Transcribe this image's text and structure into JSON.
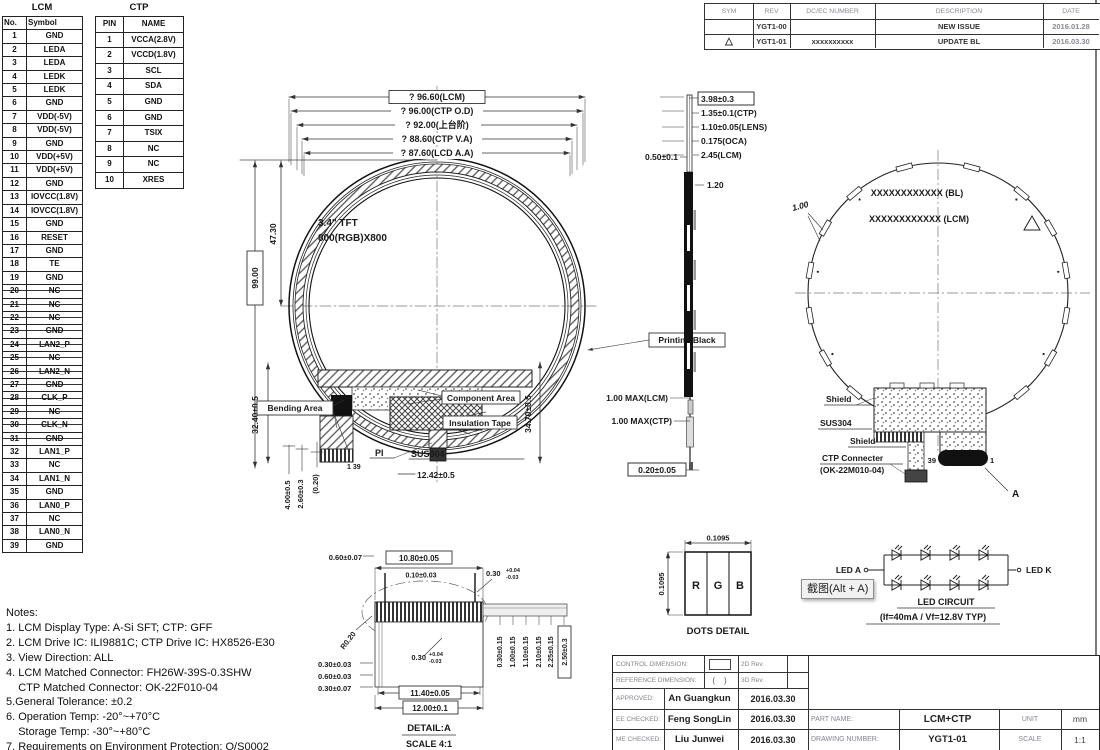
{
  "lcm_table": {
    "title": "LCM",
    "headers": [
      "No.",
      "Symbol"
    ],
    "struck_rows": [
      20,
      21,
      22,
      23,
      24,
      25,
      26,
      27,
      28,
      29,
      30,
      31
    ],
    "rows": [
      [
        "1",
        "GND"
      ],
      [
        "2",
        "LEDA"
      ],
      [
        "3",
        "LEDA"
      ],
      [
        "4",
        "LEDK"
      ],
      [
        "5",
        "LEDK"
      ],
      [
        "6",
        "GND"
      ],
      [
        "7",
        "VDD(-5V)"
      ],
      [
        "8",
        "VDD(-5V)"
      ],
      [
        "9",
        "GND"
      ],
      [
        "10",
        "VDD(+5V)"
      ],
      [
        "11",
        "VDD(+5V)"
      ],
      [
        "12",
        "GND"
      ],
      [
        "13",
        "IOVCC(1.8V)"
      ],
      [
        "14",
        "IOVCC(1.8V)"
      ],
      [
        "15",
        "GND"
      ],
      [
        "16",
        "RESET"
      ],
      [
        "17",
        "GND"
      ],
      [
        "18",
        "TE"
      ],
      [
        "19",
        "GND"
      ],
      [
        "20",
        "NC"
      ],
      [
        "21",
        "NC"
      ],
      [
        "22",
        "NC"
      ],
      [
        "23",
        "GND"
      ],
      [
        "24",
        "LAN2_P"
      ],
      [
        "25",
        "NC"
      ],
      [
        "26",
        "LAN2_N"
      ],
      [
        "27",
        "GND"
      ],
      [
        "28",
        "CLK_P"
      ],
      [
        "29",
        "NC"
      ],
      [
        "30",
        "CLK_N"
      ],
      [
        "31",
        "GND"
      ],
      [
        "32",
        "LAN1_P"
      ],
      [
        "33",
        "NC"
      ],
      [
        "34",
        "LAN1_N"
      ],
      [
        "35",
        "GND"
      ],
      [
        "36",
        "LAN0_P"
      ],
      [
        "37",
        "NC"
      ],
      [
        "38",
        "LAN0_N"
      ],
      [
        "39",
        "GND"
      ]
    ]
  },
  "ctp_table": {
    "title": "CTP",
    "headers": [
      "PIN",
      "NAME"
    ],
    "rows": [
      [
        "1",
        "VCCA(2.8V)"
      ],
      [
        "2",
        "VCCD(1.8V)"
      ],
      [
        "3",
        "SCL"
      ],
      [
        "4",
        "SDA"
      ],
      [
        "5",
        "GND"
      ],
      [
        "6",
        "GND"
      ],
      [
        "7",
        "TSIX"
      ],
      [
        "8",
        "NC"
      ],
      [
        "9",
        "NC"
      ],
      [
        "10",
        "XRES"
      ]
    ]
  },
  "revision": {
    "h_sym": "SYM",
    "h_rev": "REV",
    "h_dc": "DC/EC NUMBER",
    "h_desc": "DESCRIPTION",
    "h_date": "DATE",
    "r1_sym": "",
    "r1_rev": "YGT1-00",
    "r1_dc": "",
    "r1_desc": "NEW ISSUE",
    "r1_date": "2016.01.28",
    "r2_sym": "△",
    "r2_rev": "YGT1-01",
    "r2_dc": "xxxxxxxxxx",
    "r2_desc": "UPDATE BL",
    "r2_date": "2016.03.30"
  },
  "front_view": {
    "dia_lcm": "? 96.60(LCM)",
    "dia_ctp_od": "? 96.00(CTP O.D)",
    "dia_step": "? 92.00(上台阶)",
    "dia_ctp_va": "? 88.60(CTP V.A)",
    "dia_lcd_aa": "? 87.60(LCD A.A)",
    "panel_line1": "3.4\" TFT",
    "panel_line2": "800(RGB)X800",
    "dim_47_30": "47.30",
    "dim_99_00": "99.00",
    "dim_32_40": "32.40±0.5",
    "dim_34_70": "34.70±0.5",
    "dim_4_00": "4.00±0.5",
    "dim_2_60": "2.60±0.3",
    "dim_0_20": "(0.20)",
    "dim_12_42": "12.42±0.5",
    "label_printing_black": "Printing Black",
    "label_bending_area": "Bending Area",
    "label_component_area": "Component Area",
    "label_insulation_tape": "Insulation Tape",
    "label_pi": "PI",
    "label_sus304": "SUS304",
    "pin_marks": "1 39"
  },
  "side_view": {
    "dim_total": "3.98±0.3",
    "dim_ctp": "1.35±0.1(CTP)",
    "dim_lens": "1.10±0.05(LENS)",
    "dim_oca": "0.175(OCA)",
    "dim_lcm": "2.45(LCM)",
    "dim_gap": "0.50±0.1",
    "dim_step": "1.20",
    "dim_lcm_max": "1.00 MAX(LCM)",
    "dim_ctp_max": "1.00 MAX(CTP)",
    "dim_tail": "0.20±0.05"
  },
  "back_view": {
    "label_bl": "XXXXXXXXXXXX (BL)",
    "label_lcm": "XXXXXXXXXXXX (LCM)",
    "dim_1_00": "1.00",
    "shield1": "Shield",
    "sus304": "SUS304",
    "shield2": "Shield",
    "conn1": "CTP Connecter",
    "conn2": "(OK-22M010-04)",
    "pin39": "39",
    "pin1": "1",
    "ref_a": "A"
  },
  "detail_a": {
    "top_left": "0.60±0.07",
    "width_top": "10.80±0.05",
    "pin_w": "0.10±0.03",
    "pitch": "0.30",
    "pitch_p": "+0.04",
    "pitch_m": "-0.03",
    "radius": "R0.20",
    "mid": "0.30",
    "mid_p": "+0.04",
    "mid_m": "-0.03",
    "left1": "0.30±0.03",
    "left2": "0.60±0.03",
    "left3": "0.30±0.07",
    "r1": "0.30±0.15",
    "r2": "1.00±0.15",
    "r3": "1.10±0.15",
    "r4": "2.10±0.15",
    "r5": "2.25±0.15",
    "r6": "2.50±0.3",
    "width_mid": "11.40±0.05",
    "width_bot": "12.00±0.1",
    "title": "DETAIL:A",
    "scale": "SCALE 4:1"
  },
  "dots_detail": {
    "dim_w": "0.1095",
    "dim_h": "0.1095",
    "r": "R",
    "g": "G",
    "b": "B",
    "label": "DOTS DETAIL"
  },
  "led_circuit": {
    "anode": "LED A",
    "cathode": "LED K",
    "title": "LED CIRCUIT",
    "spec": "(If=40mA / Vf=12.8V TYP)",
    "tooltip": "截图(Alt + A)"
  },
  "notes": {
    "lines": [
      "Notes:",
      "1. LCM Display Type: A-Si SFT; CTP: GFF",
      "2. LCM Drive IC: ILI9881C; CTP Drive IC: HX8526-E30",
      "3. View Direction: ALL",
      "4. LCM Matched Connector: FH26W-39S-0.3SHW",
      "    CTP Matched Connector: OK-22F010-04",
      "5.General Tolerance: ±0.2",
      "6. Operation Temp: -20°~+70°C",
      "    Storage Temp: -30°~+80°C",
      "7. Requirements on Environment Protection: Q/S0002"
    ]
  },
  "title_block": {
    "ctrl": "CONTROL DIMENSION:",
    "ref": "REFERENCE DIMENSION:",
    "ref_sym": "(    )",
    "rev2d": "2D Rev.",
    "rev3d": "3D Rev.",
    "approved_l": "APPROVED:",
    "approved_n": "An Guangkun",
    "approved_d": "2016.03.30",
    "ee_l": "EE CHECKED:",
    "ee_n": "Feng SongLin",
    "ee_d": "2016.03.30",
    "me_l": "ME CHECKED:",
    "me_n": "Liu Junwei",
    "me_d": "2016.03.30",
    "part_l": "PART NAME:",
    "part_v": "LCM+CTP",
    "unit_l": "UNIT",
    "unit_v": "mm",
    "dwg_l": "DRAWING NUMBER:",
    "dwg_v": "YGT1-01",
    "scale_l": "SCALE",
    "scale_v": "1:1"
  }
}
